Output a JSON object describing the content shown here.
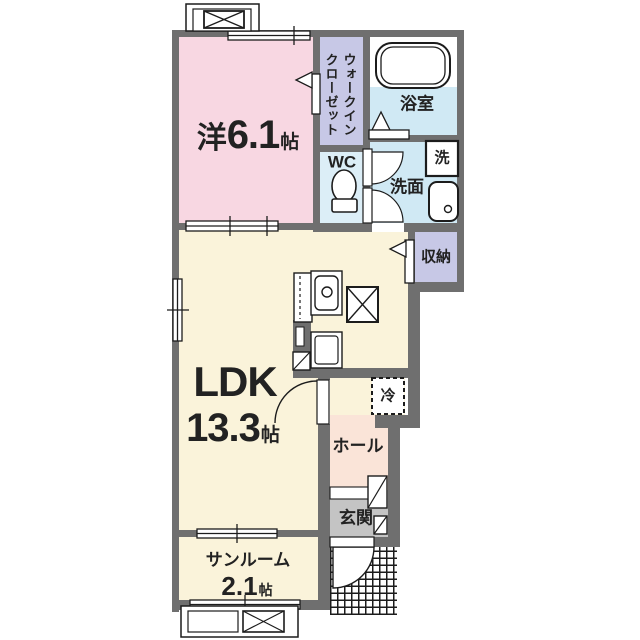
{
  "colors": {
    "wall": "#6f6f6f",
    "bedroom": "#f8d7e2",
    "closet": "#c7c8e6",
    "bath": "#d0e9f4",
    "wc": "#dceef7",
    "washroom": "#d0e9f4",
    "storage": "#c7c8e6",
    "ldk": "#faf3da",
    "hall": "#fae4d8",
    "entrance_floor": "#c4c4c4",
    "line": "#1c1c1c"
  },
  "labels": {
    "bedroom": {
      "prefix": "洋",
      "size": "6.1",
      "unit": "帖"
    },
    "walk_in_closet": {
      "line1": "ウォークイン",
      "line2": "クローゼット"
    },
    "bathroom": "浴室",
    "toilet": "WC",
    "washroom": "洗面",
    "washer": "洗",
    "storage": "収納",
    "ldk": {
      "name": "LDK",
      "size": "13.3",
      "unit": "帖"
    },
    "refrigerator": "冷",
    "hall": "ホール",
    "entrance": "玄関",
    "sunroom": {
      "name": "サンルーム",
      "size": "2.1",
      "unit": "帖"
    }
  }
}
